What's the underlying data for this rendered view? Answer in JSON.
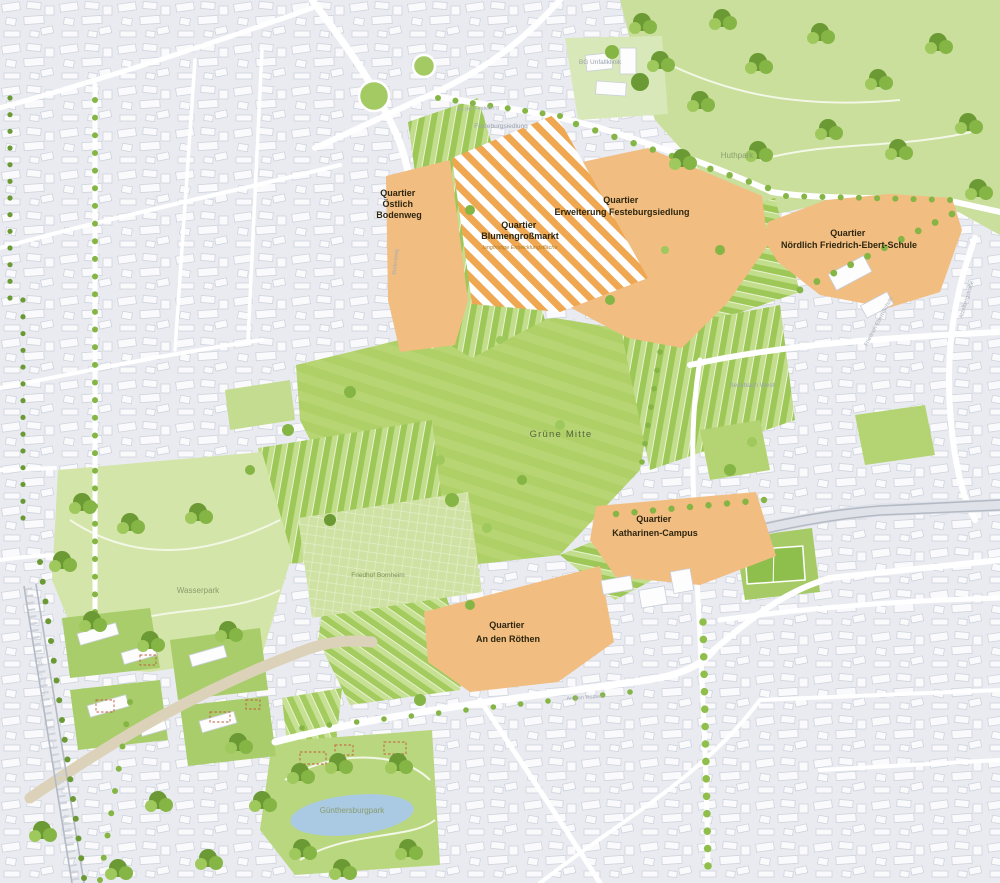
{
  "map": {
    "quartiers": [
      {
        "title": "Quartier",
        "l2": "Östlich",
        "l3": "Bodenweg"
      },
      {
        "title": "Quartier",
        "l2": "Blumengroßmarkt",
        "subtitle": "langfristige Entwicklungsfläche"
      },
      {
        "title": "Quartier",
        "l2": "Erweiterung Festeburgsiedlung"
      },
      {
        "title": "Quartier",
        "l2": "Nördlich Friedrich-Ebert-Schule"
      },
      {
        "title": "Quartier",
        "l2": "Katharinen-Campus"
      },
      {
        "title": "Quartier",
        "l2": "An den Röthen"
      }
    ],
    "green_spaces": {
      "huthpark": "Huthpark",
      "gruene_mitte": "Grüne Mitte",
      "wasserpark": "Wasserpark",
      "guenthersburgpark": "Günthersburgpark",
      "friedhof_bornheim": "Friedhof Bornheim"
    },
    "areas": {
      "seckbach_west": "Seckbach West",
      "festeburgsiedlung": "Festeburgsiedlung",
      "bg_unfallklinik": "BG Unfallklinik",
      "friedrich_ebert_schule": "Friedrich-Ebert-Schule"
    },
    "streets": {
      "an_den_roethen": "An den Röthen",
      "bodenweg": "Bodenweg",
      "atzelbergstrasse": "Atzelbergstraße",
      "an_der_festeburg": "An der Festeburg"
    },
    "colors": {
      "quartier_orange": "#f1bd80",
      "hatch_orange": "#efa851",
      "meadow_green": "#b5d470",
      "park_green": "#c9df9b",
      "tree_green": "#85b545",
      "urban_gray": "#e9ebf1",
      "pond_blue": "#aac9e2",
      "label_dark": "#2e2610"
    }
  }
}
